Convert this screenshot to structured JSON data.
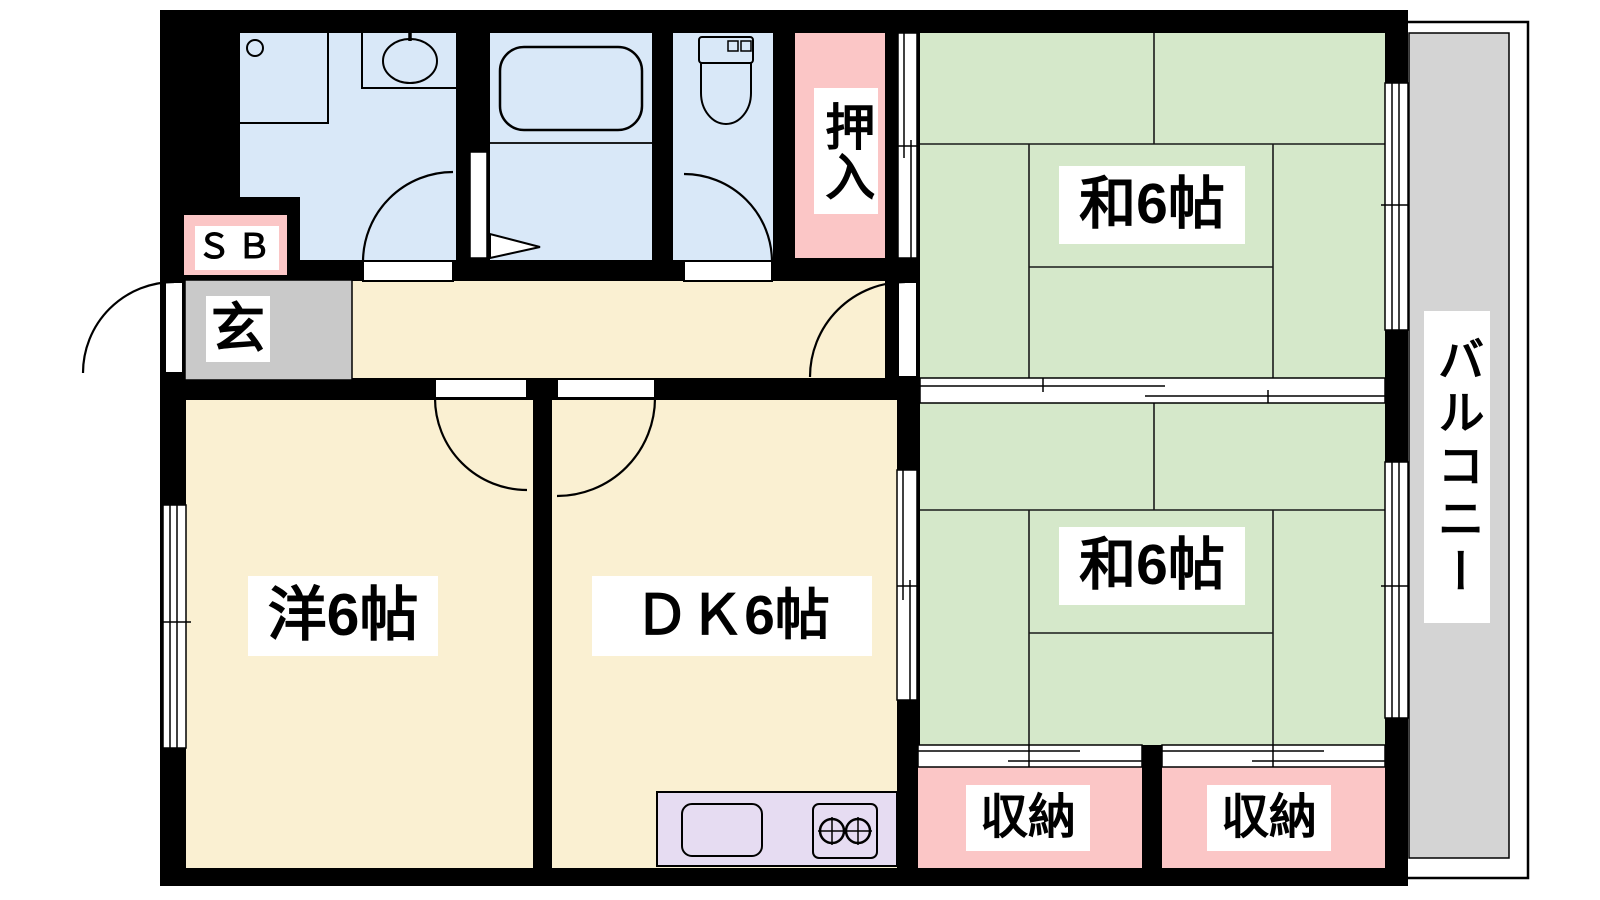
{
  "diagram_type": "apartment-floor-plan",
  "rooms": {
    "japanese_room_1": {
      "label": "和6帖"
    },
    "japanese_room_2": {
      "label": "和6帖"
    },
    "western_room": {
      "label": "洋6帖"
    },
    "dining_kitchen": {
      "label": "ＤＫ6帖"
    },
    "closet": {
      "label": "押入"
    },
    "storage_left": {
      "label": "収納"
    },
    "storage_right": {
      "label": "収納"
    },
    "balcony": {
      "label": "バルコニー"
    },
    "entrance": {
      "label": "玄"
    },
    "shoe_box": {
      "label": "ＳＢ"
    }
  },
  "colors": {
    "wall": "#000000",
    "tatami_green": "#d5e8ca",
    "floor_cream": "#faf0d2",
    "wet_area_blue": "#d9e8f8",
    "closet_pink": "#fbc6c6",
    "entrance_gray": "#c9c9c9",
    "balcony_gray": "#d4d4d4",
    "kitchen_lavender": "#e6dcf2"
  }
}
